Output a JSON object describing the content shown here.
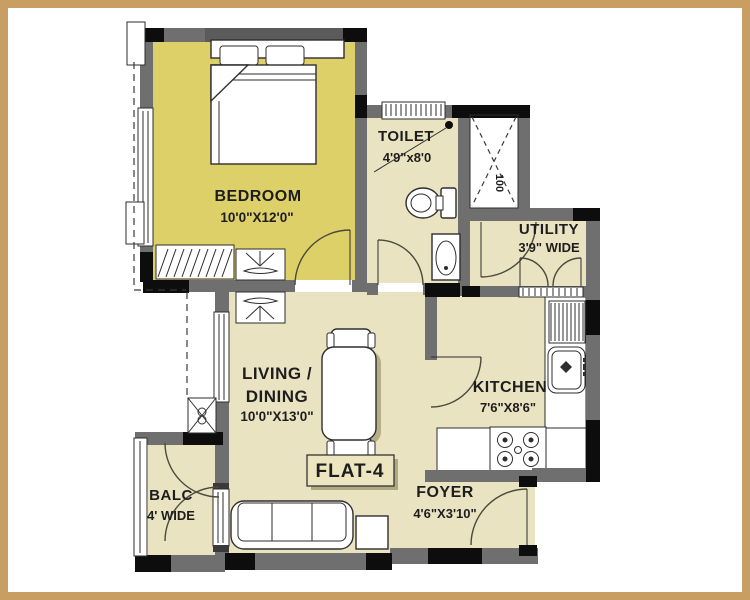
{
  "colors": {
    "page_border": "#c99e62",
    "background": "#ffffff",
    "bedroom_fill": "#ddd069",
    "room_fill": "#eae3c2",
    "wall_gray": "#6f6f6f",
    "wall_black": "#0d0d0d",
    "line": "#2e2e2e",
    "text": "#1d1d1d"
  },
  "flat_label": "FLAT-4",
  "rooms": {
    "bedroom": {
      "name": "BEDROOM",
      "dims": "10'0\"X12'0\""
    },
    "toilet": {
      "name": "TOILET",
      "dims": "4'9\"x8'0"
    },
    "utility": {
      "name": "UTILITY",
      "dims": "3'9\" WIDE"
    },
    "living_dining": {
      "name_line1": "LIVING /",
      "name_line2": "DINING",
      "dims": "10'0\"X13'0\""
    },
    "kitchen": {
      "name": "KITCHEN",
      "dims": "7'6\"X8'6\""
    },
    "foyer": {
      "name": "FOYER",
      "dims": "4'6\"X3'10\""
    },
    "balcony": {
      "name": "BALC",
      "dims": "4' WIDE"
    },
    "duct": {
      "label": "100"
    }
  },
  "fixtures": {
    "bedroom": [
      "double-bed",
      "wardrobe",
      "tv-unit"
    ],
    "living": [
      "tv-unit",
      "dining-table",
      "chairs",
      "sofa",
      "side-table"
    ],
    "toilet": [
      "wc",
      "wash-basin",
      "floor-trap"
    ],
    "kitchen": [
      "l-counter",
      "drain-board",
      "sink",
      "hob-4-burner"
    ],
    "exterior": [
      "ac-unit",
      "duct-shaft"
    ]
  }
}
